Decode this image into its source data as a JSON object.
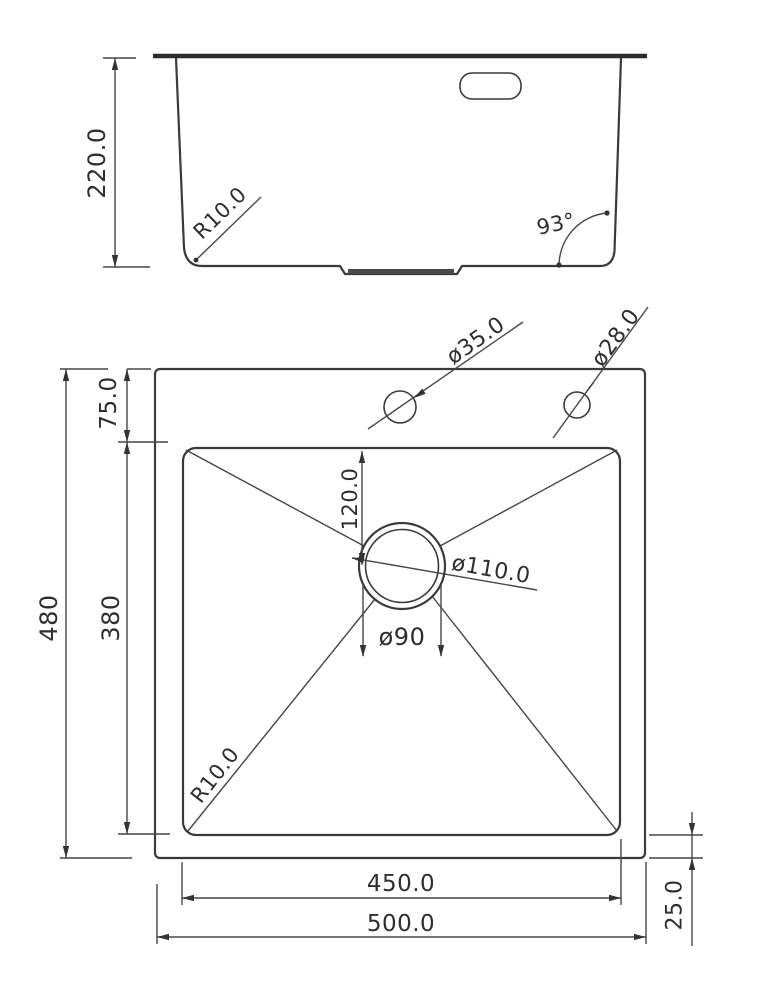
{
  "colors": {
    "ink": "#333333",
    "background": "#ffffff"
  },
  "side_view": {
    "depth": "220.0",
    "bottom_corner_radius": "R10.0",
    "wall_angle": "93°"
  },
  "top_view": {
    "faucet_hole_diameter": "ø35.0",
    "accessory_hole_diameter": "ø28.0",
    "rim_top_width": "75.0",
    "overall_depth": "480",
    "bowl_depth": "380",
    "drain_center_offset": "120.0",
    "drain_flange_diameter": "ø110.0",
    "drain_hole_diameter": "ø90",
    "bowl_corner_radius": "R10.0",
    "bowl_width": "450.0",
    "overall_width": "500.0",
    "rim_bottom_width": "25.0"
  }
}
